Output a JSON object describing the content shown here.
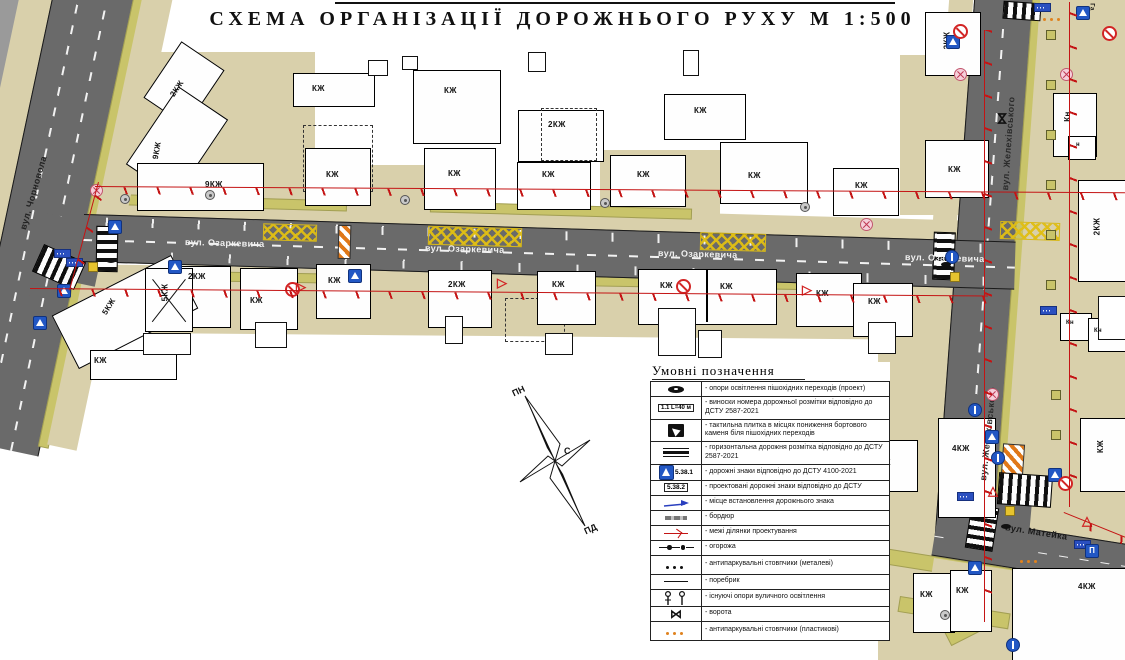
{
  "title": "СХЕМА ОРГАНІЗАЦІЇ ДОРОЖНЬОГО РУХУ М 1:500",
  "compass": {
    "north": "ПН",
    "center": "С",
    "south": "ПД"
  },
  "streets": {
    "chornovola": "вул. Чорновола",
    "ozarkevycha": "вул. Озаркевича",
    "zhelekhivskoho": "вул. Желехівського",
    "mateika": "вул. Матейка"
  },
  "labels": {
    "top_right_partial": "Га"
  },
  "signs": {
    "parking_letter": "П"
  },
  "icons": {
    "yield_sign": "▷",
    "warning_sign": "△",
    "gate": "⋈",
    "direction_arrow": "↑"
  },
  "legend": {
    "title": "Умовні позначення",
    "callout_label": "1.1 L=40 м",
    "sign_existing_label": "5.38.1",
    "sign_projected_label": "5.38.2",
    "items": [
      {
        "text": "- опори освітлення пішохідних переходів (проект)"
      },
      {
        "text": "- виноски номера дорожньої розмітки відповідно до ДСТУ 2587-2021"
      },
      {
        "text": "- тактильна плитка в місцях пониження бортового каменя біля пішохідних переходів"
      },
      {
        "text": "- горизонтальна дорожня розмітка відповідно до ДСТУ 2587-2021"
      },
      {
        "text": "- дорожні знаки відповідно до ДСТУ 4100-2021"
      },
      {
        "text": "- проектовані дорожні знаки відповідно до ДСТУ"
      },
      {
        "text": "- місце встановлення дорожнього знака"
      },
      {
        "text": "- бордюр"
      },
      {
        "text": "- межі ділянки проектування"
      },
      {
        "text": "- огорожа"
      },
      {
        "text": "- антипаркувальні стовпчики (металеві)"
      },
      {
        "text": "- поребрик"
      },
      {
        "text": "- існуючі опори вуличного освітлення"
      },
      {
        "text": "- ворота"
      },
      {
        "text": "- антипаркувальні стовпчики (пластикові)"
      }
    ]
  },
  "buildings": [
    {
      "label": "2КЖ"
    },
    {
      "label": "9КЖ"
    },
    {
      "label": "9КЖ"
    },
    {
      "label": "КЖ"
    },
    {
      "label": "КЖ"
    },
    {
      "label": "2КЖ"
    },
    {
      "label": "КЖ"
    },
    {
      "label": "КЖ"
    },
    {
      "label": "КЖ"
    },
    {
      "label": "КЖ"
    },
    {
      "label": "КЖ"
    },
    {
      "label": "КЖ"
    },
    {
      "label": "КЖ"
    },
    {
      "label": "КЖ"
    },
    {
      "label": "2КЖ"
    },
    {
      "label": "Кн"
    },
    {
      "label": "н"
    },
    {
      "label": "2КЖ"
    },
    {
      "label": "Кн"
    },
    {
      "label": "Кн"
    },
    {
      "label": "2КЖ"
    },
    {
      "label": "5КЖ"
    },
    {
      "label": "5КЖ"
    },
    {
      "label": "2КЖ"
    },
    {
      "label": "КЖ"
    },
    {
      "label": "КЖ"
    },
    {
      "label": "КЖ"
    },
    {
      "label": "КЖ"
    },
    {
      "label": "КЖ"
    },
    {
      "label": "КЖ"
    },
    {
      "label": "КЖ"
    },
    {
      "label": "КЖ"
    },
    {
      "label": "4КЖ"
    },
    {
      "label": "КЖ"
    },
    {
      "label": "КЖ"
    },
    {
      "label": "КЖ"
    },
    {
      "label": "КЖ"
    },
    {
      "label": "4КЖ"
    }
  ]
}
